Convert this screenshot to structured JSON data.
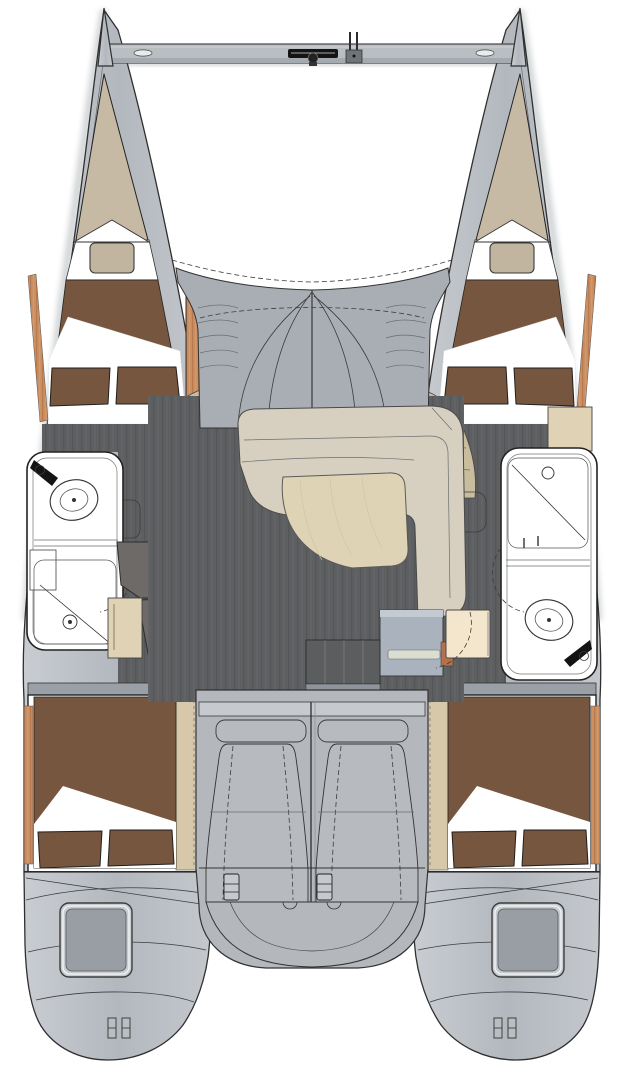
{
  "document": {
    "title": "Catamaran interior layout plan",
    "type": "floorplan-diagram",
    "view": "top-down"
  },
  "palette": {
    "background": "#ffffff",
    "hullGray": "#b7bcc1",
    "hullLight": "#c9cdd2",
    "hullMid": "#b3b8be",
    "outline": "#2f2f2f",
    "coachGray": "#a9aeb4",
    "cockpitGray": "#b4b8bd",
    "benchGray": "#c6cacf",
    "seatGray": "#b7bbc0",
    "beamGray": "#b9bec3",
    "floorDark": "#5d5f61",
    "floorStripe": "#54565a",
    "bedBrown": "#77563f",
    "linenWhite": "#ffffff",
    "forepeakTan": "#c7baa5",
    "pillowTan": "#c2b59f",
    "woodOrange": "#c98e61",
    "woodOrangeDark": "#b87a4e",
    "stepsKhaki": "#c9bd9d",
    "shelfTan": "#d8c8aa",
    "cabinetTan": "#e0d2b4",
    "setteeCream": "#d7d0c0",
    "tableWood": "#ded4b5",
    "counterDark": "#6e6a67",
    "applianceWhite": "#f8f8f8",
    "navDeskGray": "#a9b2bd",
    "navSeatCream": "#f4e6cc",
    "stepsDark": "#5b5d5f",
    "fixtureBlack": "#141414"
  },
  "regions": {
    "bow_crossbeam": "bow crossbeam with anchor windlass and forestay fitting",
    "trampoline": "open trampoline area between bows",
    "port_forepeak": "port bow locker",
    "starboard_forepeak": "starboard bow locker",
    "port_forward_cabin": "port forward double berth",
    "starboard_forward_cabin": "starboard forward double berth",
    "port_head": "port bathroom with toilet, sink and shower",
    "starboard_head": "starboard bathroom with shower and toilet",
    "galley": "galley with cooktop and double sink",
    "salon": "salon with L-shaped settee and table",
    "nav_station": "chart table with seat",
    "companionway": "entry steps",
    "cockpit": "cockpit with bench and twin seats",
    "port_aft_cabin": "port aft double berth",
    "starboard_aft_cabin": "starboard aft double berth",
    "port_stern": "port transom with hatch and boarding steps",
    "starboard_stern": "starboard transom with hatch and boarding steps"
  }
}
